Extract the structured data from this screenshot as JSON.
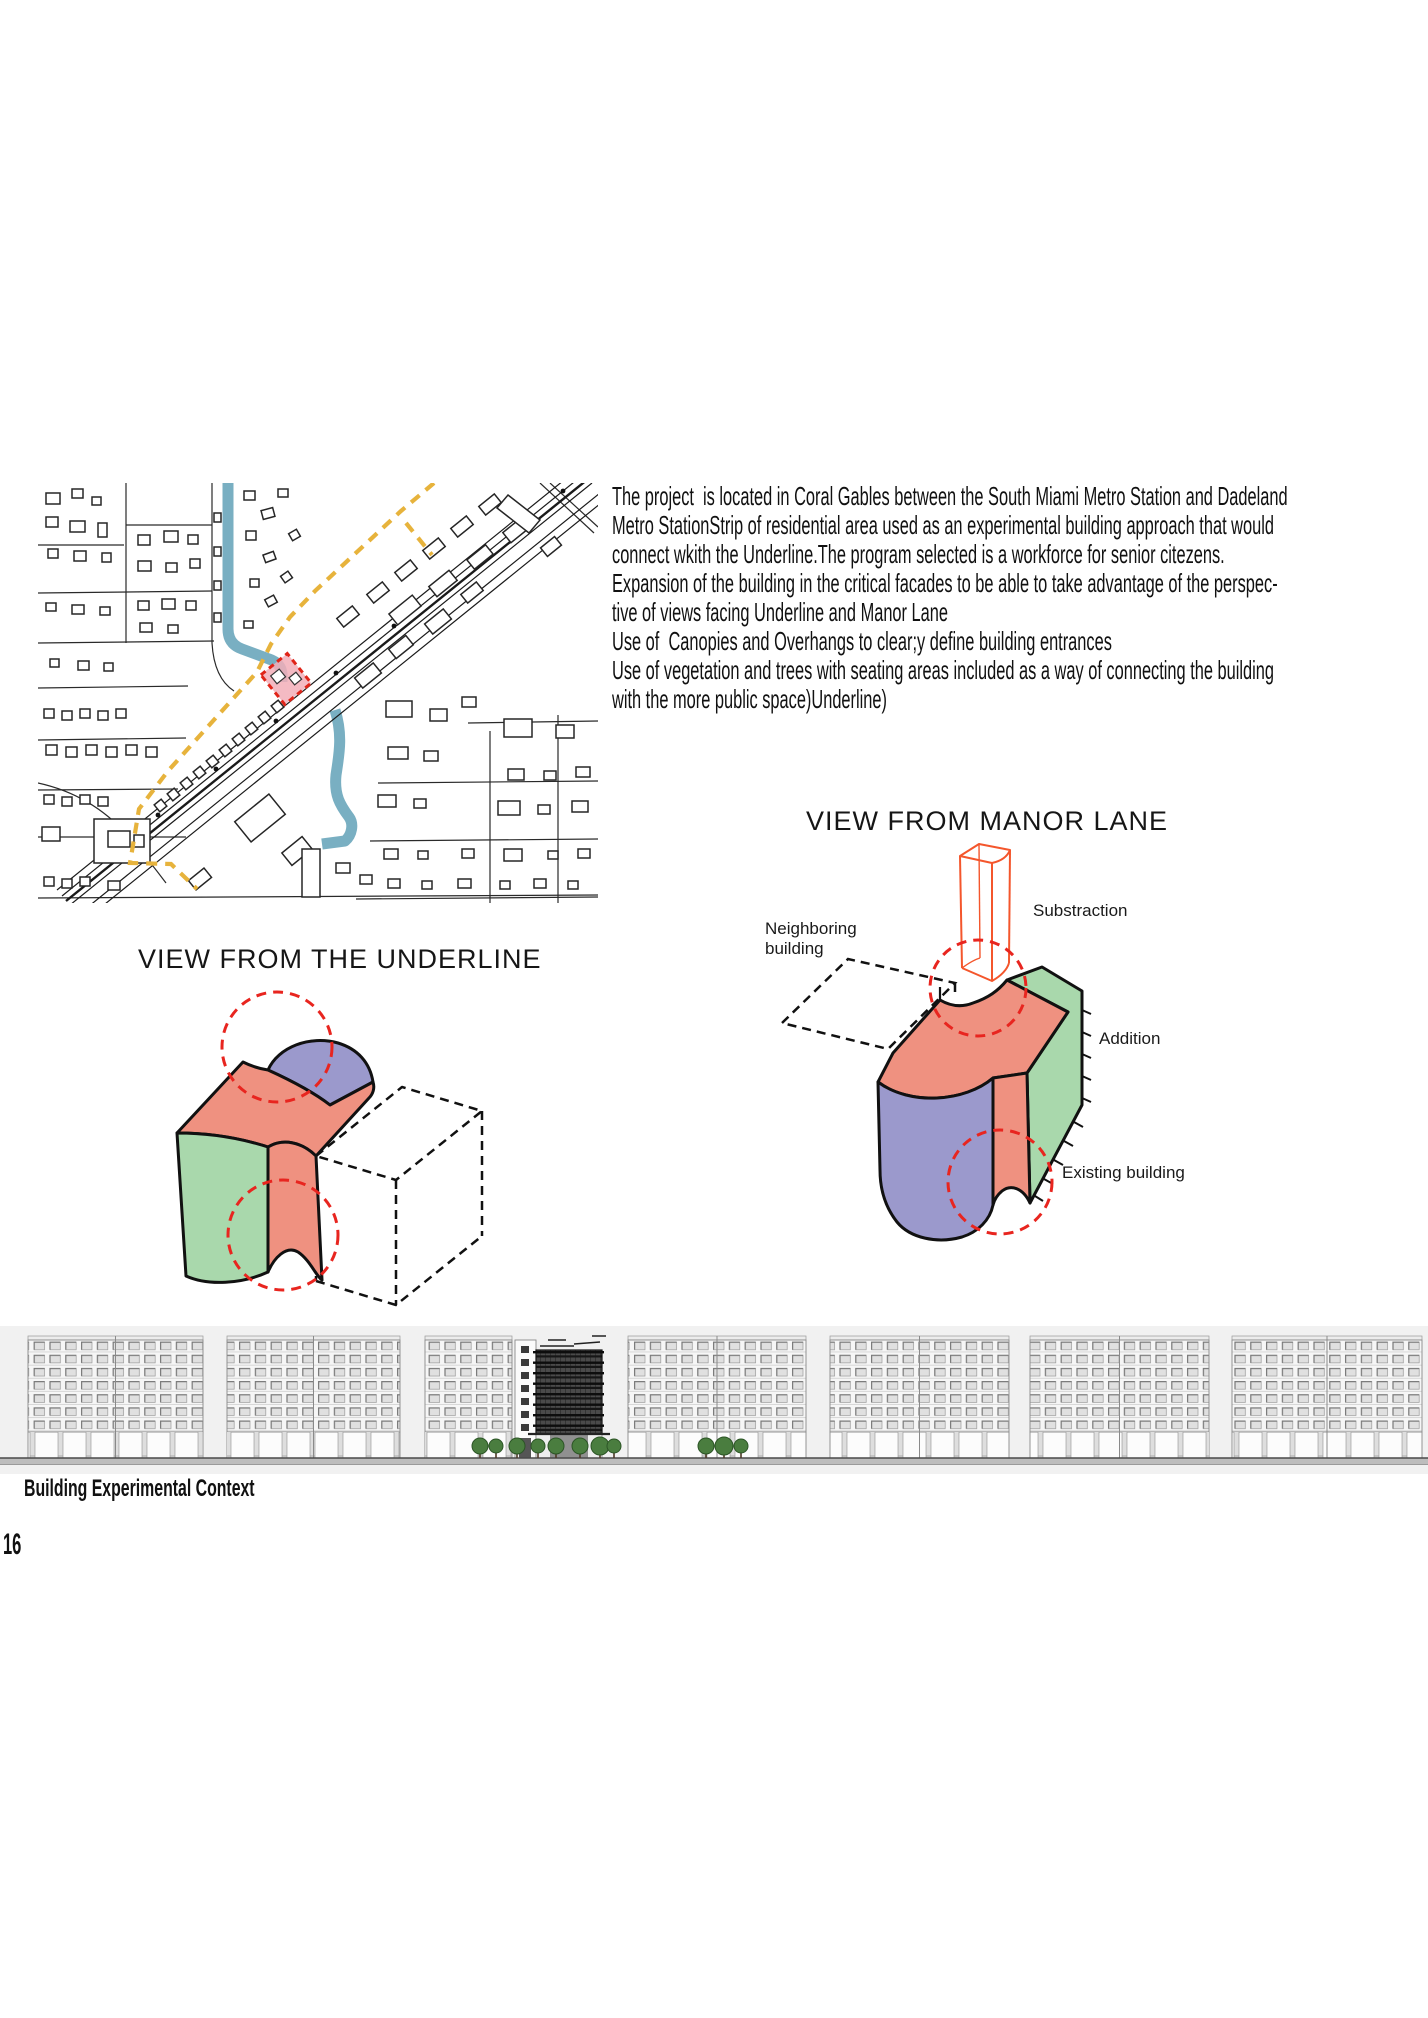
{
  "page": {
    "number": "16",
    "background": "#ffffff"
  },
  "description": {
    "lines": [
      "The project  is located in Coral Gables between the South Miami Metro Station and Dadeland",
      "Metro StationStrip of residential area used as an experimental building approach that would",
      "connect wkith the Underline.The program selected is a workforce for senior citezens.",
      "Expansion of the building in the critical facades to be able to take advantage of the perspec-",
      "tive of views facing Underline and Manor Lane",
      "Use of  Canopies and Overhangs to clear;y define building entrances",
      "Use of vegetation and trees with seating areas included as a way of connecting the building",
      "with the more public space)Underline)"
    ]
  },
  "views": {
    "underline": {
      "title": "VIEW FROM THE UNDERLINE"
    },
    "manor": {
      "title": "VIEW FROM MANOR LANE",
      "labels": {
        "neighboring_line1": "Neighboring",
        "neighboring_line2": "building",
        "substraction": "Substraction",
        "addition": "Addition",
        "existing": "Existing building"
      }
    }
  },
  "elevation": {
    "caption": "Building Experimental Context"
  },
  "colors": {
    "volume_salmon": "#EF9180",
    "volume_green": "#A9D8AC",
    "volume_purple": "#9B99CC",
    "highlight_red_dashed": "#E8251F",
    "substraction_orange": "#F4562C",
    "map_route_yellow": "#E7B33C",
    "map_canal_blue": "#79AFC2",
    "map_site_pink": "#F2AEB8",
    "map_site_red": "#E02418"
  }
}
